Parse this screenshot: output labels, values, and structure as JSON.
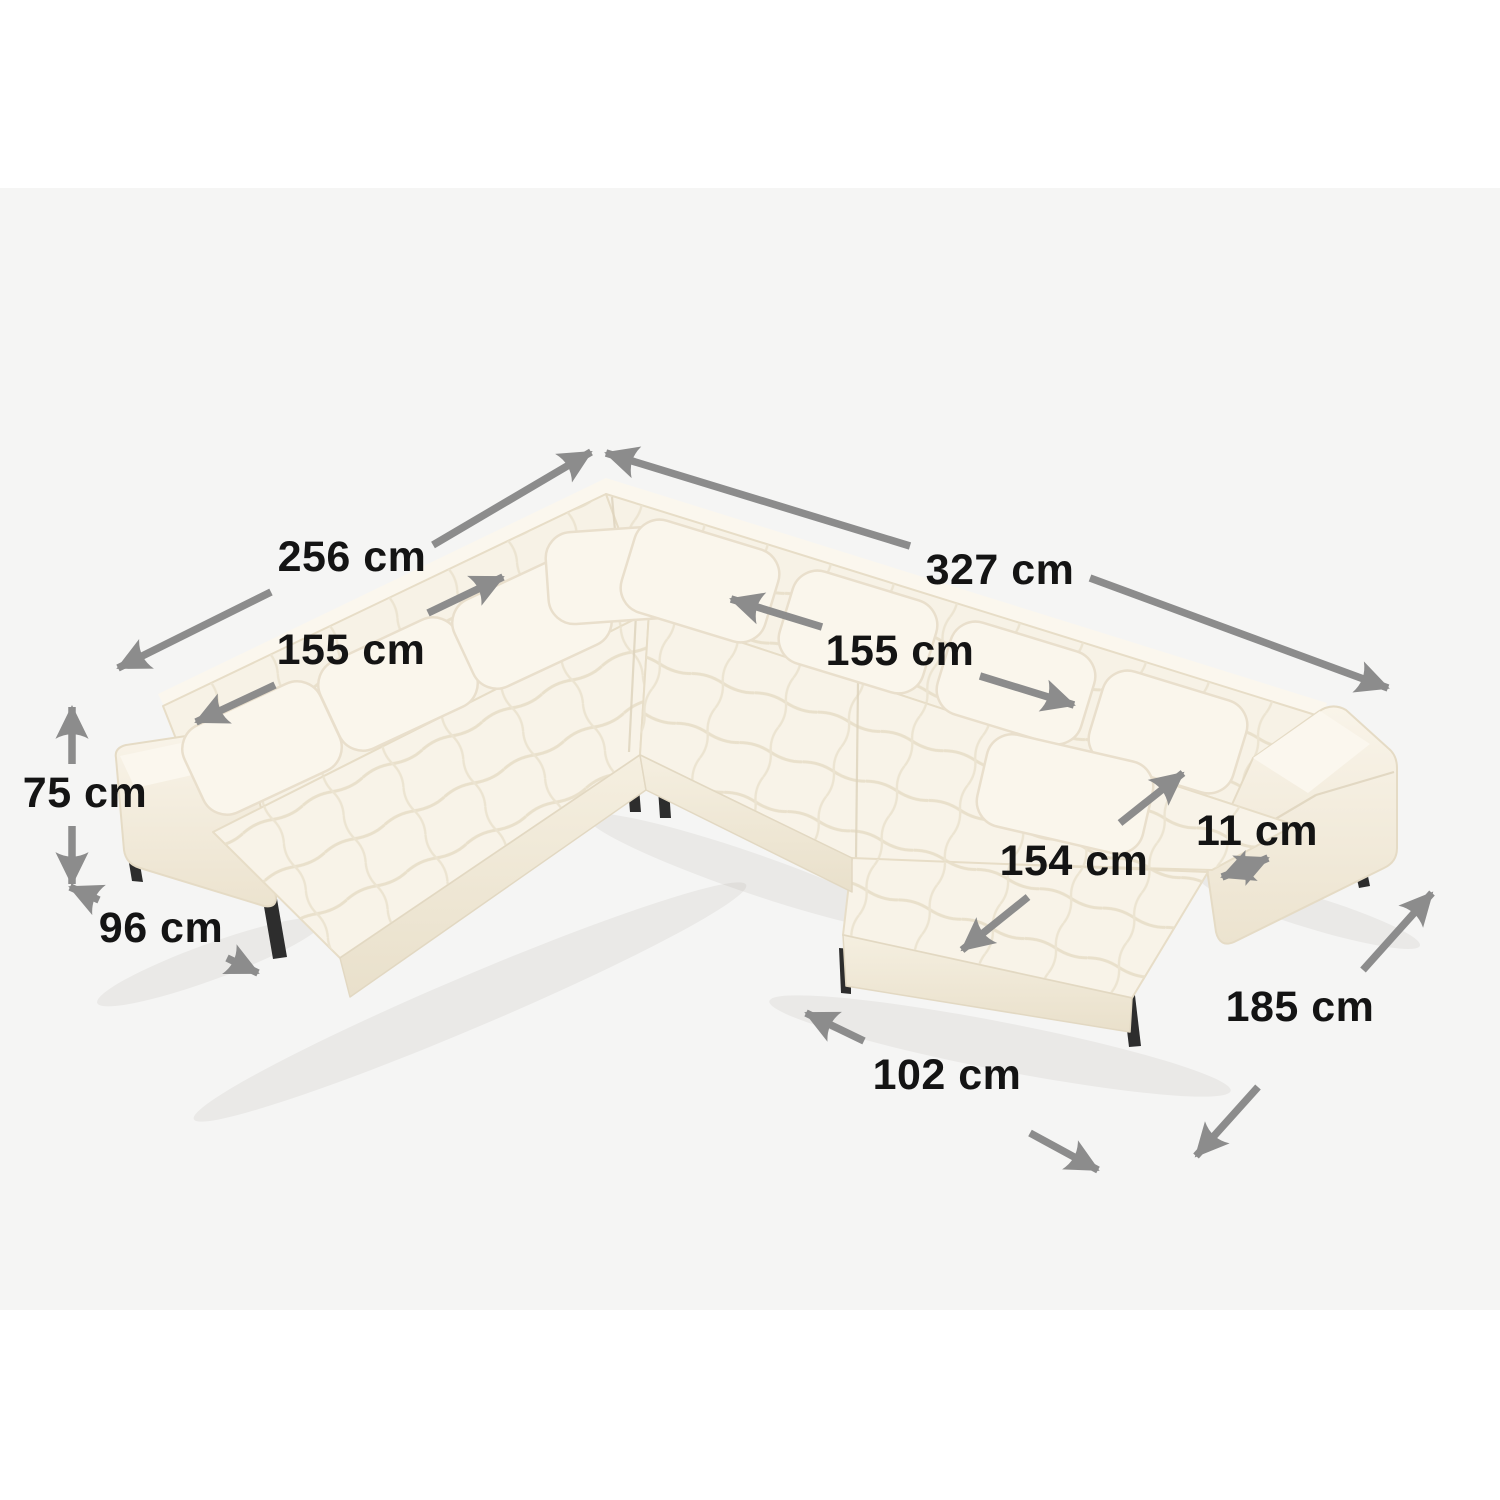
{
  "scene": {
    "type": "product-dimension-diagram",
    "subject": "U-shaped panoramic sectional sofa, tufted cream fabric, black metal legs",
    "background_color": "#ffffff",
    "stage_color": "#f5f5f4",
    "arrow_color": "#8c8c8c",
    "label_color": "#141414",
    "fabric_color": "#f8f3e8",
    "fabric_shade_color": "#efe7d5",
    "fabric_deep_shade_color": "#e7dec9",
    "leg_color": "#2d2d2d",
    "unit": "cm"
  },
  "measurements": {
    "left_back_length": "256 cm",
    "right_back_length": "327 cm",
    "left_seat_span": "155 cm",
    "right_seat_span": "155 cm",
    "total_height": "75 cm",
    "seat_depth": "96 cm",
    "chaise_length": "154 cm",
    "armrest_width": "11 cm",
    "right_side_depth": "185 cm",
    "chaise_width": "102 cm"
  }
}
